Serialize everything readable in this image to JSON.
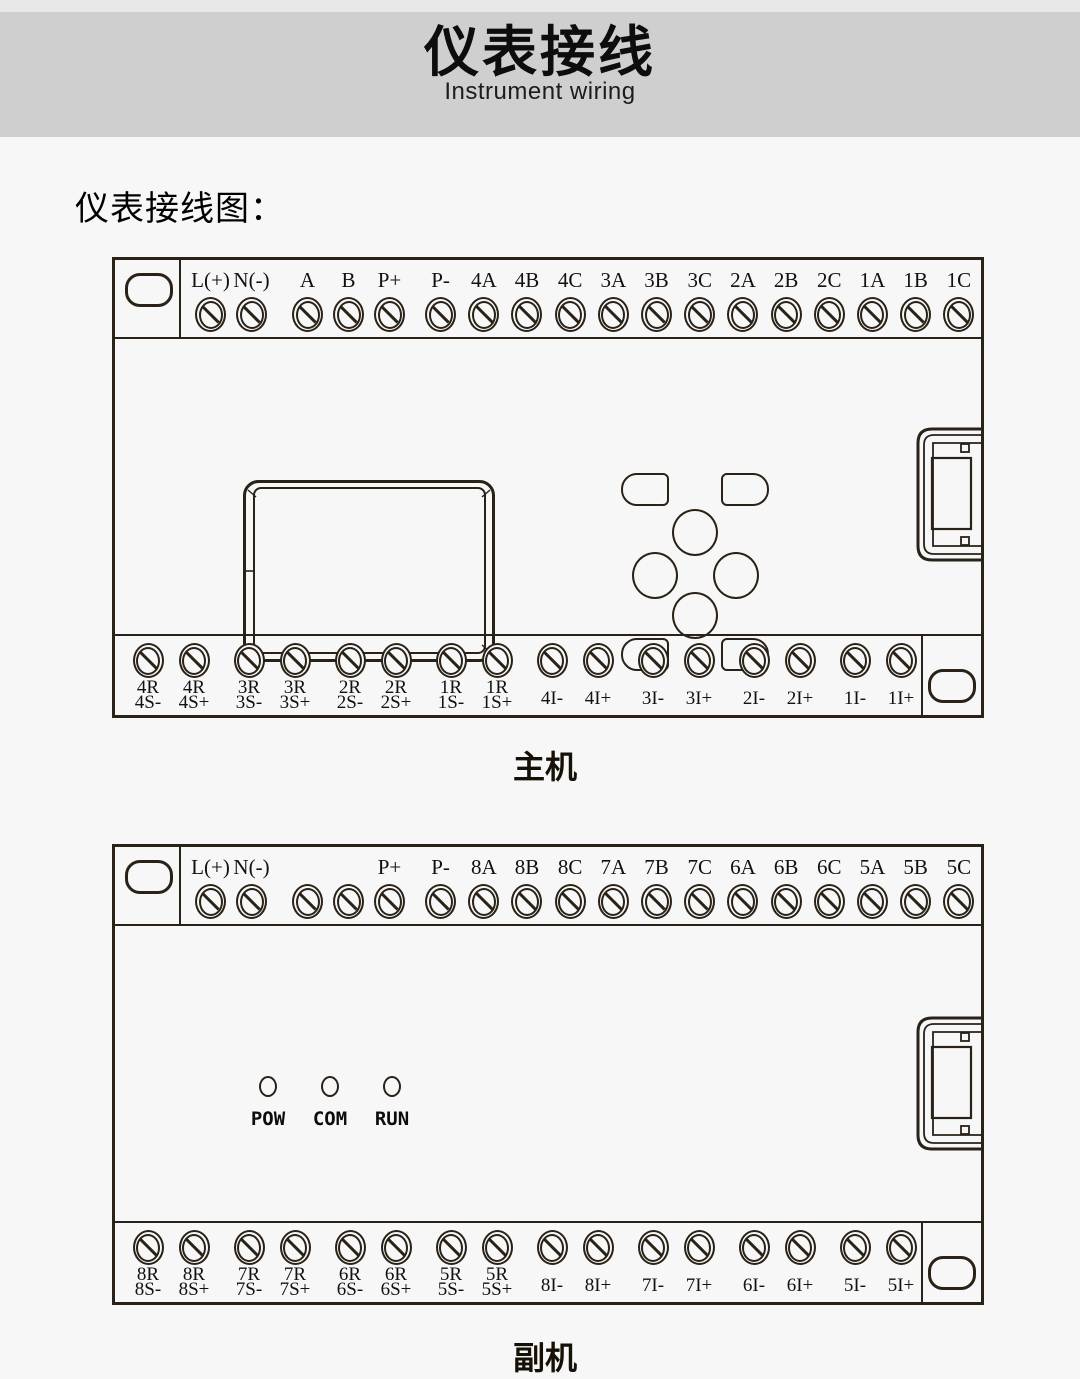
{
  "banner": {
    "title": "仪表接线",
    "subtitle": "Instrument wiring",
    "bg": "#cfcfcf",
    "topbar_bg": "#e8e8e8"
  },
  "page": {
    "bg": "#f7f7f7",
    "line_color": "#2a2117"
  },
  "section_heading": "仪表接线图：",
  "units": [
    {
      "name": "main-unit",
      "caption": "主机",
      "top_terminal_groups": [
        [
          "L(+)",
          "N(-)"
        ],
        [
          "A",
          "B",
          "P+"
        ],
        [
          "P-",
          "4A",
          "4B",
          "4C",
          "3A",
          "3B",
          "3C",
          "2A",
          "2B",
          "2C",
          "1A",
          "1B",
          "1C"
        ]
      ],
      "bottom_terminal_groups": [
        [
          [
            "4R",
            "4S-"
          ],
          [
            "4R",
            "4S+"
          ]
        ],
        [
          [
            "3R",
            "3S-"
          ],
          [
            "3R",
            "3S+"
          ]
        ],
        [
          [
            "2R",
            "2S-"
          ],
          [
            "2R",
            "2S+"
          ]
        ],
        [
          [
            "1R",
            "1S-"
          ],
          [
            "1R",
            "1S+"
          ]
        ],
        [
          [
            "4I-"
          ],
          [
            "4I+"
          ]
        ],
        [
          [
            "3I-"
          ],
          [
            "3I+"
          ]
        ],
        [
          [
            "2I-"
          ],
          [
            "2I+"
          ]
        ],
        [
          [
            "1I-"
          ],
          [
            "1I+"
          ]
        ]
      ],
      "leds": []
    },
    {
      "name": "aux-unit",
      "caption": "副机",
      "top_terminal_groups": [
        [
          "L(+)",
          "N(-)"
        ],
        [
          "",
          "",
          "P+"
        ],
        [
          "P-",
          "8A",
          "8B",
          "8C",
          "7A",
          "7B",
          "7C",
          "6A",
          "6B",
          "6C",
          "5A",
          "5B",
          "5C"
        ]
      ],
      "bottom_terminal_groups": [
        [
          [
            "8R",
            "8S-"
          ],
          [
            "8R",
            "8S+"
          ]
        ],
        [
          [
            "7R",
            "7S-"
          ],
          [
            "7R",
            "7S+"
          ]
        ],
        [
          [
            "6R",
            "6S-"
          ],
          [
            "6R",
            "6S+"
          ]
        ],
        [
          [
            "5R",
            "5S-"
          ],
          [
            "5R",
            "5S+"
          ]
        ],
        [
          [
            "8I-"
          ],
          [
            "8I+"
          ]
        ],
        [
          [
            "7I-"
          ],
          [
            "7I+"
          ]
        ],
        [
          [
            "6I-"
          ],
          [
            "6I+"
          ]
        ],
        [
          [
            "5I-"
          ],
          [
            "5I+"
          ]
        ]
      ],
      "leds": [
        "POW",
        "COM",
        "RUN"
      ]
    }
  ]
}
